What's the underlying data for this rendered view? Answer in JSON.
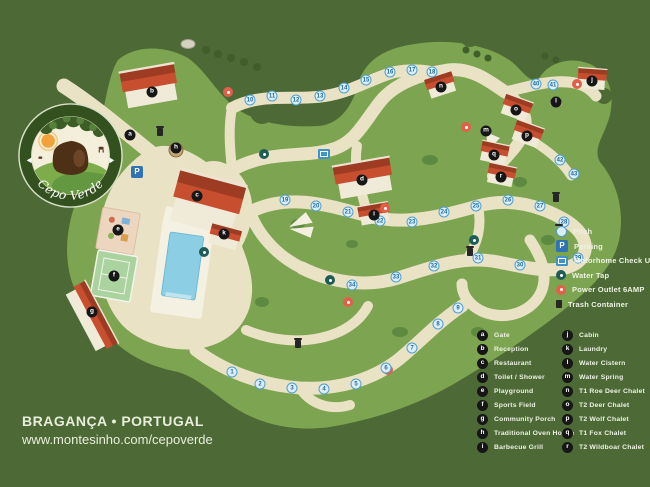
{
  "branding": {
    "logo_name": "Cepo Verde",
    "location": "BRAGANÇA • PORTUGAL",
    "website": "www.montesinho.com/cepoverde"
  },
  "colors": {
    "background": "#4c6936",
    "terrain": "#7da450",
    "path": "#e9e2c5",
    "roof": "#c84e30",
    "pool": "#8ccfe5",
    "pitch_marker": "#ddeefa",
    "parking": "#2e74b5",
    "power_outlet": "#e2604a",
    "water_tap": "#1e5c55",
    "facility_marker": "#161616",
    "legend_text": "#edf2e3"
  },
  "legend_amenities": {
    "items": [
      {
        "icon": "pitch",
        "glyph": "",
        "label": "Pitch"
      },
      {
        "icon": "parking",
        "glyph": "P",
        "label": "Parking"
      },
      {
        "icon": "checkup",
        "glyph": "",
        "label": "Motorhome Check Up"
      },
      {
        "icon": "watertap",
        "glyph": "",
        "label": "Water Tap"
      },
      {
        "icon": "power",
        "glyph": "",
        "label": "Power Outlet 6AMP"
      },
      {
        "icon": "trash",
        "glyph": "",
        "label": "Trash Container"
      }
    ]
  },
  "legend_places": {
    "column1": [
      {
        "key": "a",
        "label": "Gate"
      },
      {
        "key": "b",
        "label": "Reception"
      },
      {
        "key": "c",
        "label": "Restaurant"
      },
      {
        "key": "d",
        "label": "Toilet / Shower"
      },
      {
        "key": "e",
        "label": "Playground"
      },
      {
        "key": "f",
        "label": "Sports Field"
      },
      {
        "key": "g",
        "label": "Community Porch"
      },
      {
        "key": "h",
        "label": "Traditional Oven House"
      },
      {
        "key": "i",
        "label": "Barbecue Grill"
      }
    ],
    "column2": [
      {
        "key": "j",
        "label": "Cabin"
      },
      {
        "key": "k",
        "label": "Laundry"
      },
      {
        "key": "l",
        "label": "Water Cistern"
      },
      {
        "key": "m",
        "label": "Water Spring"
      },
      {
        "key": "n",
        "label": "T1 Roe Deer Chalet"
      },
      {
        "key": "o",
        "label": "T2 Deer Chalet"
      },
      {
        "key": "p",
        "label": "T2 Wolf Chalet"
      },
      {
        "key": "q",
        "label": "T1 Fox Chalet"
      },
      {
        "key": "r",
        "label": "T2 Wildboar Chalet"
      }
    ]
  },
  "map": {
    "letter_markers": [
      {
        "key": "a",
        "x": 130,
        "y": 135
      },
      {
        "key": "b",
        "x": 152,
        "y": 92
      },
      {
        "key": "c",
        "x": 197,
        "y": 196
      },
      {
        "key": "d",
        "x": 362,
        "y": 180
      },
      {
        "key": "e",
        "x": 118,
        "y": 230
      },
      {
        "key": "f",
        "x": 114,
        "y": 276
      },
      {
        "key": "g",
        "x": 92,
        "y": 312
      },
      {
        "key": "h",
        "x": 176,
        "y": 148
      },
      {
        "key": "i",
        "x": 374,
        "y": 215
      },
      {
        "key": "j",
        "x": 592,
        "y": 81
      },
      {
        "key": "k",
        "x": 224,
        "y": 234
      },
      {
        "key": "l",
        "x": 556,
        "y": 102
      },
      {
        "key": "m",
        "x": 486,
        "y": 131
      },
      {
        "key": "n",
        "x": 441,
        "y": 87
      },
      {
        "key": "o",
        "x": 516,
        "y": 110
      },
      {
        "key": "p",
        "x": 527,
        "y": 136
      },
      {
        "key": "q",
        "x": 494,
        "y": 155
      },
      {
        "key": "r",
        "x": 501,
        "y": 177
      }
    ],
    "pitch_markers": [
      {
        "n": 1,
        "x": 232,
        "y": 372
      },
      {
        "n": 2,
        "x": 260,
        "y": 384
      },
      {
        "n": 3,
        "x": 292,
        "y": 388
      },
      {
        "n": 4,
        "x": 324,
        "y": 389
      },
      {
        "n": 5,
        "x": 356,
        "y": 384
      },
      {
        "n": 6,
        "x": 386,
        "y": 368
      },
      {
        "n": 7,
        "x": 412,
        "y": 348
      },
      {
        "n": 8,
        "x": 438,
        "y": 324
      },
      {
        "n": 9,
        "x": 458,
        "y": 308
      },
      {
        "n": 10,
        "x": 250,
        "y": 100
      },
      {
        "n": 11,
        "x": 272,
        "y": 96
      },
      {
        "n": 12,
        "x": 296,
        "y": 100
      },
      {
        "n": 13,
        "x": 320,
        "y": 96
      },
      {
        "n": 14,
        "x": 344,
        "y": 88
      },
      {
        "n": 15,
        "x": 366,
        "y": 80
      },
      {
        "n": 16,
        "x": 390,
        "y": 72
      },
      {
        "n": 17,
        "x": 412,
        "y": 70
      },
      {
        "n": 18,
        "x": 432,
        "y": 72
      },
      {
        "n": 19,
        "x": 285,
        "y": 200
      },
      {
        "n": 20,
        "x": 316,
        "y": 206
      },
      {
        "n": 21,
        "x": 348,
        "y": 212
      },
      {
        "n": 22,
        "x": 380,
        "y": 221
      },
      {
        "n": 23,
        "x": 412,
        "y": 222
      },
      {
        "n": 24,
        "x": 444,
        "y": 212
      },
      {
        "n": 25,
        "x": 476,
        "y": 206
      },
      {
        "n": 26,
        "x": 508,
        "y": 200
      },
      {
        "n": 27,
        "x": 540,
        "y": 206
      },
      {
        "n": 28,
        "x": 564,
        "y": 222
      },
      {
        "n": 29,
        "x": 578,
        "y": 258
      },
      {
        "n": 30,
        "x": 520,
        "y": 265
      },
      {
        "n": 31,
        "x": 478,
        "y": 258
      },
      {
        "n": 32,
        "x": 434,
        "y": 266
      },
      {
        "n": 33,
        "x": 396,
        "y": 277
      },
      {
        "n": 34,
        "x": 352,
        "y": 285
      },
      {
        "n": 40,
        "x": 536,
        "y": 84
      },
      {
        "n": 41,
        "x": 553,
        "y": 85
      },
      {
        "n": 42,
        "x": 560,
        "y": 160
      },
      {
        "n": 43,
        "x": 574,
        "y": 174
      }
    ],
    "amenity_markers": [
      {
        "type": "parking",
        "label": "P",
        "x": 137,
        "y": 172
      },
      {
        "type": "checkup",
        "x": 324,
        "y": 154
      },
      {
        "type": "watertap",
        "x": 264,
        "y": 154
      },
      {
        "type": "watertap",
        "x": 330,
        "y": 280
      },
      {
        "type": "watertap",
        "x": 474,
        "y": 240
      },
      {
        "type": "watertap",
        "x": 204,
        "y": 252
      },
      {
        "type": "power",
        "x": 228,
        "y": 92
      },
      {
        "type": "power",
        "x": 385,
        "y": 208
      },
      {
        "type": "power",
        "x": 348,
        "y": 302
      },
      {
        "type": "power",
        "x": 388,
        "y": 370
      },
      {
        "type": "power",
        "x": 577,
        "y": 84
      },
      {
        "type": "power",
        "x": 466,
        "y": 127
      },
      {
        "type": "trash",
        "x": 160,
        "y": 132
      },
      {
        "type": "trash",
        "x": 298,
        "y": 344
      },
      {
        "type": "trash",
        "x": 470,
        "y": 252
      },
      {
        "type": "trash",
        "x": 556,
        "y": 198
      }
    ]
  }
}
